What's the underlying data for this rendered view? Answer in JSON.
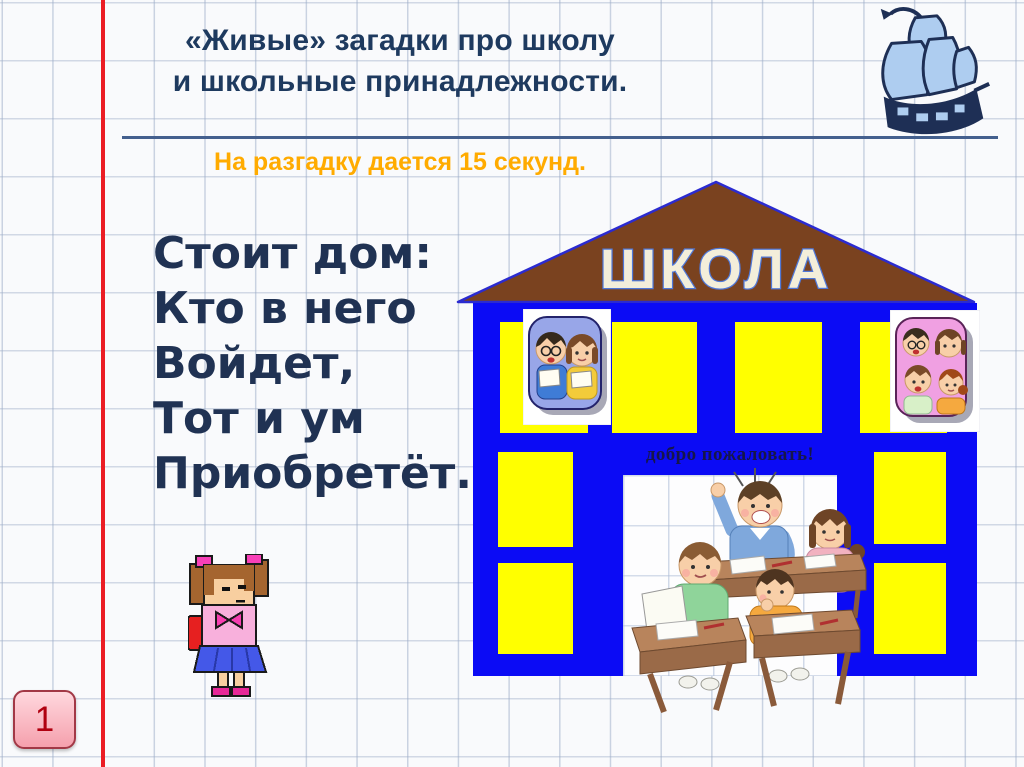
{
  "slide": {
    "title": {
      "line1": "«Живые» загадки про школу",
      "line2": "и школьные принадлежности."
    },
    "timer_note": "На разгадку дается 15 секунд.",
    "riddle": {
      "lines": [
        "Стоит дом:",
        "Кто в него",
        "Войдет,",
        "Тот и ум",
        "Приобретёт."
      ]
    },
    "slide_number": "1"
  },
  "school_building": {
    "sign_text": "ШКОЛА",
    "welcome_text": "добро пожаловать!"
  },
  "icons": {
    "ship": "sailing-ship-clipart",
    "schoolgirl": "pixel-schoolgirl-with-backpack",
    "window_photo_left": "two-children-reading",
    "window_photo_right": "four-children-group",
    "classroom": "children-at-desks-scene"
  },
  "colors": {
    "margin_red": "#EB1C24",
    "title_navy": "#1E3A5F",
    "timer_orange": "#FFAB00",
    "building_blue": "#0B0BF5",
    "window_yellow": "#FFFF00",
    "roof_brown": "#7A421F",
    "sign_cream": "#F3EEDA",
    "welcome_navy": "#16164A",
    "badge_pink": "#F5A0AD",
    "badge_text_red": "#B00010"
  }
}
